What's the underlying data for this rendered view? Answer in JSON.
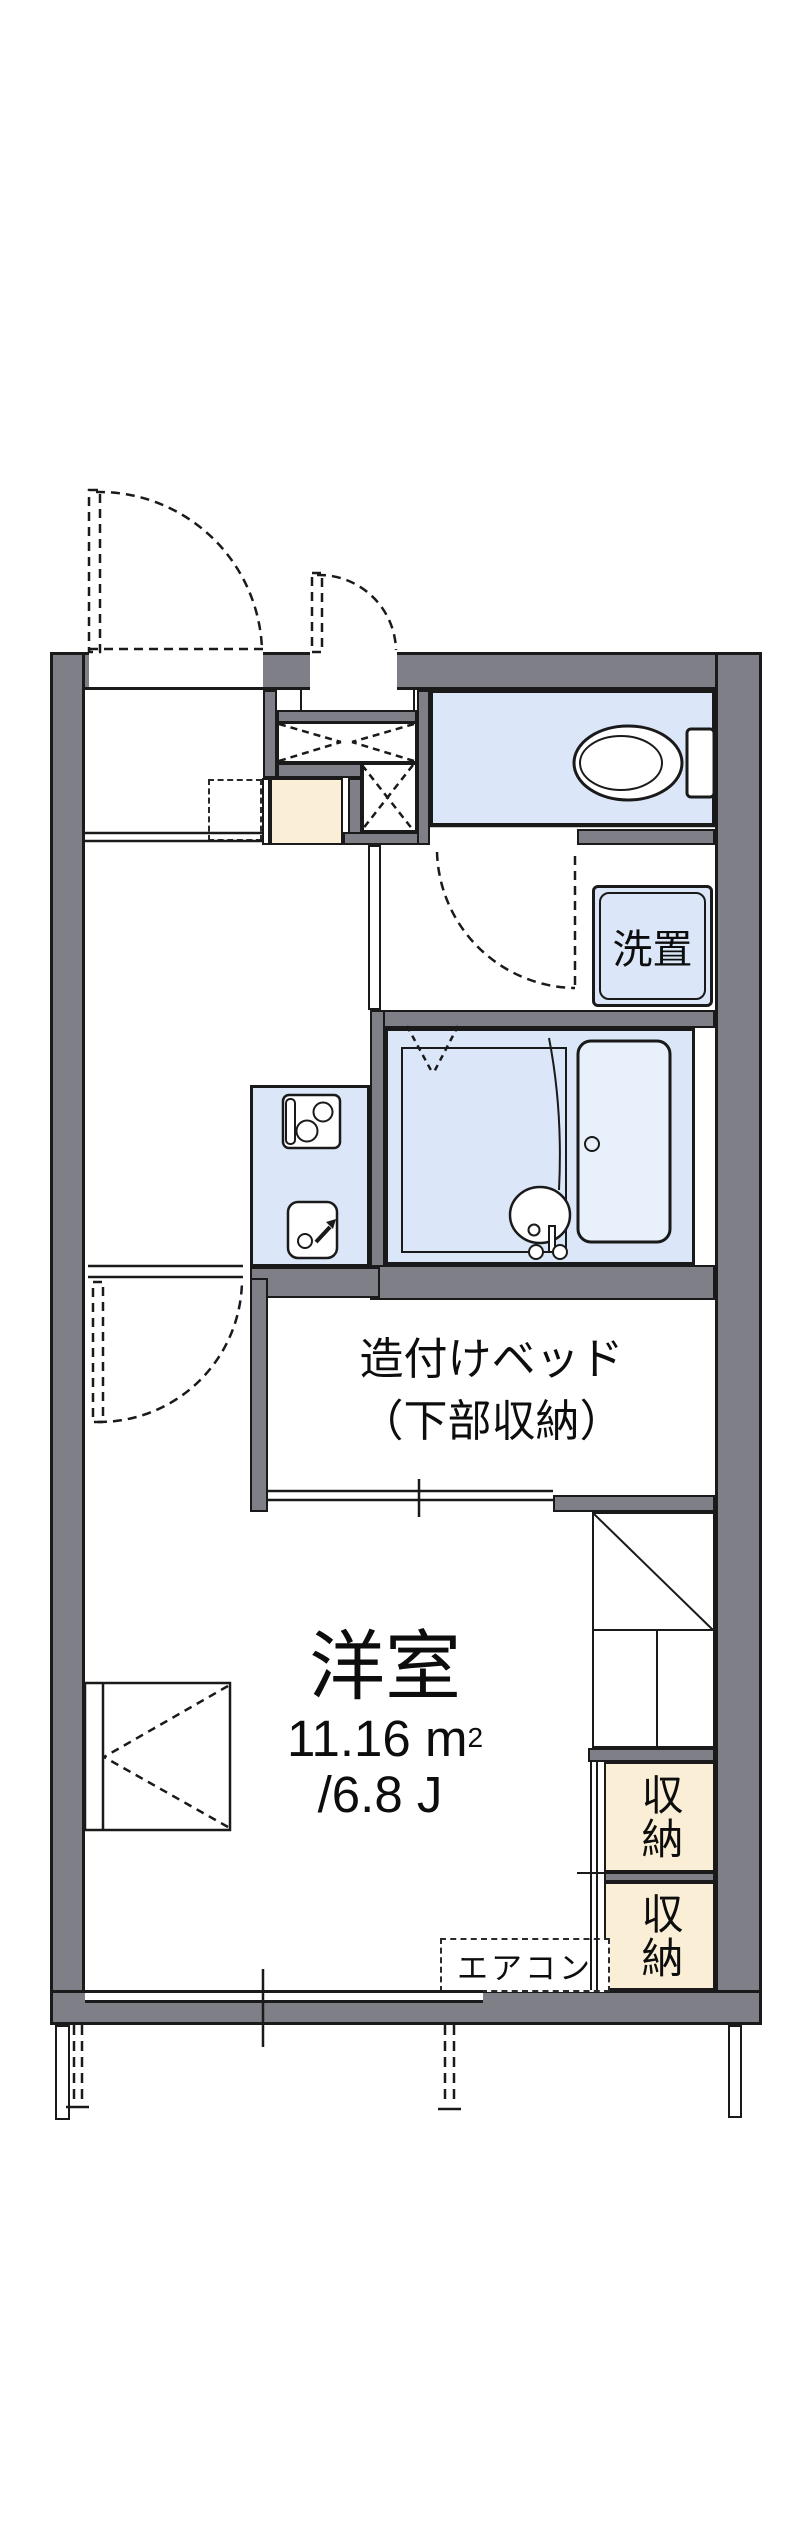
{
  "plan": {
    "type": "floorplan",
    "colors": {
      "wall_gray": "#7f7f87",
      "wet_area_blue": "#dbe7f8",
      "entry_storage_cream": "#faefd6",
      "line_black": "#1a1a1a",
      "background": "#ffffff"
    },
    "labels": {
      "washer": "洗置",
      "bed_line1": "造付けベッド",
      "bed_line2": "（下部収納）",
      "room_name": "洋室",
      "room_area_value": "11.16 m",
      "room_area_sup": "2",
      "room_area_jo": "/6.8 J",
      "storage1": "収納",
      "storage2": "収納",
      "aircon": "エアコン"
    }
  }
}
